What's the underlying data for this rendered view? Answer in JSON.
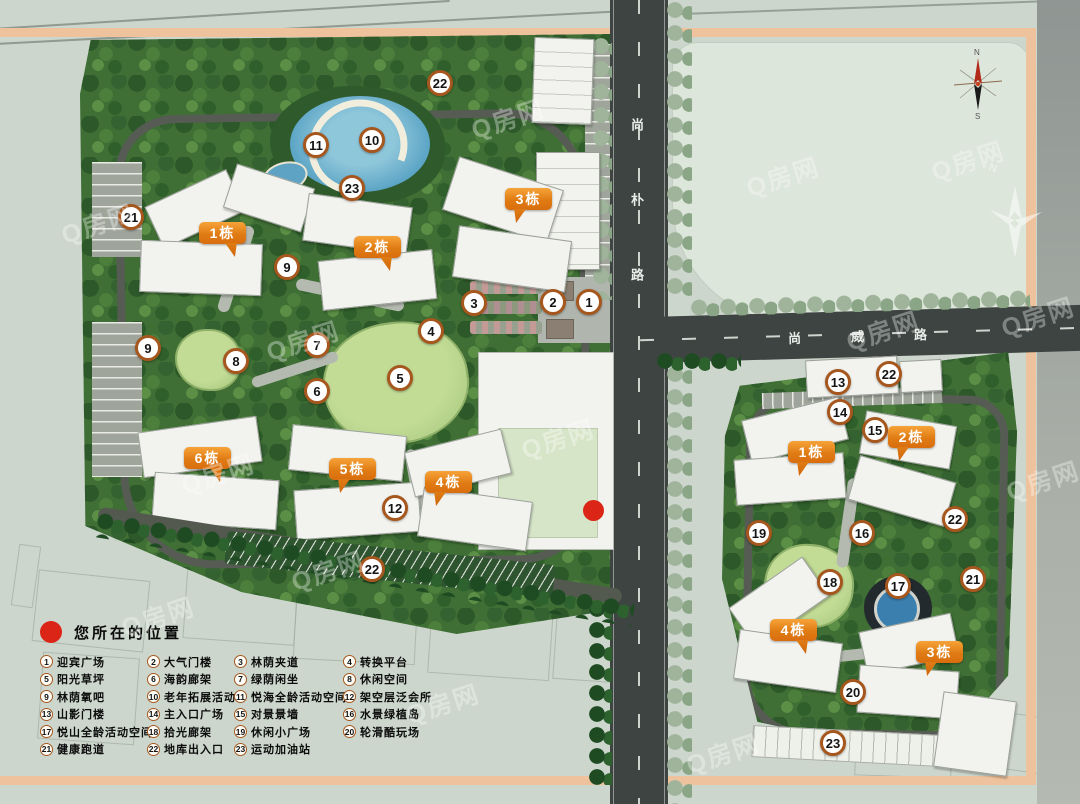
{
  "map": {
    "roads": {
      "vertical_road": "尚朴路",
      "horizontal_road": "尚威路"
    },
    "compass": {
      "north_label": "N",
      "south_label": "S"
    },
    "watermark_text": "Q房网"
  },
  "legend": {
    "title": "您所在的位置",
    "items": [
      {
        "num": "1",
        "label": "迎宾广场"
      },
      {
        "num": "2",
        "label": "大气门楼"
      },
      {
        "num": "3",
        "label": "林荫夹道"
      },
      {
        "num": "4",
        "label": "转换平台"
      },
      {
        "num": "5",
        "label": "阳光草坪"
      },
      {
        "num": "6",
        "label": "海韵廊架"
      },
      {
        "num": "7",
        "label": "绿荫闲坐"
      },
      {
        "num": "8",
        "label": "休闲空间"
      },
      {
        "num": "9",
        "label": "林荫氧吧"
      },
      {
        "num": "10",
        "label": "老年拓展活动"
      },
      {
        "num": "11",
        "label": "悦海全龄活动空间"
      },
      {
        "num": "12",
        "label": "架空层泛会所"
      },
      {
        "num": "13",
        "label": "山影门楼"
      },
      {
        "num": "14",
        "label": "主入口广场"
      },
      {
        "num": "15",
        "label": "对景景墙"
      },
      {
        "num": "16",
        "label": "水景绿植岛"
      },
      {
        "num": "17",
        "label": "悦山全龄活动空间"
      },
      {
        "num": "18",
        "label": "拾光廊架"
      },
      {
        "num": "19",
        "label": "休闲小广场"
      },
      {
        "num": "20",
        "label": "轮滑酷玩场"
      },
      {
        "num": "21",
        "label": "健康跑道"
      },
      {
        "num": "22",
        "label": "地库出入口"
      },
      {
        "num": "23",
        "label": "运动加油站"
      }
    ]
  },
  "building_labels": [
    {
      "plan": "left",
      "text": "1栋",
      "x": 199,
      "y": 222,
      "tail": "right"
    },
    {
      "plan": "left",
      "text": "2栋",
      "x": 354,
      "y": 236,
      "tail": "right"
    },
    {
      "plan": "left",
      "text": "3栋",
      "x": 505,
      "y": 188,
      "tail": "left"
    },
    {
      "plan": "left",
      "text": "6栋",
      "x": 184,
      "y": 447,
      "tail": "right"
    },
    {
      "plan": "left",
      "text": "5栋",
      "x": 329,
      "y": 458,
      "tail": "left"
    },
    {
      "plan": "left",
      "text": "4栋",
      "x": 425,
      "y": 471,
      "tail": "left"
    },
    {
      "plan": "right",
      "text": "1栋",
      "x": 788,
      "y": 441,
      "tail": "left"
    },
    {
      "plan": "right",
      "text": "2栋",
      "x": 888,
      "y": 426,
      "tail": "left"
    },
    {
      "plan": "right",
      "text": "4栋",
      "x": 770,
      "y": 619,
      "tail": "right"
    },
    {
      "plan": "right",
      "text": "3栋",
      "x": 916,
      "y": 641,
      "tail": "left"
    }
  ],
  "markers": [
    {
      "plan": "left",
      "n": "22",
      "x": 440,
      "y": 83
    },
    {
      "plan": "left",
      "n": "11",
      "x": 316,
      "y": 145
    },
    {
      "plan": "left",
      "n": "10",
      "x": 372,
      "y": 140
    },
    {
      "plan": "left",
      "n": "23",
      "x": 352,
      "y": 188
    },
    {
      "plan": "left",
      "n": "21",
      "x": 131,
      "y": 217
    },
    {
      "plan": "left",
      "n": "9",
      "x": 287,
      "y": 267
    },
    {
      "plan": "left",
      "n": "3",
      "x": 474,
      "y": 303
    },
    {
      "plan": "left",
      "n": "2",
      "x": 553,
      "y": 302
    },
    {
      "plan": "left",
      "n": "1",
      "x": 589,
      "y": 302
    },
    {
      "plan": "left",
      "n": "9",
      "x": 148,
      "y": 348
    },
    {
      "plan": "left",
      "n": "8",
      "x": 236,
      "y": 361
    },
    {
      "plan": "left",
      "n": "7",
      "x": 317,
      "y": 345
    },
    {
      "plan": "left",
      "n": "4",
      "x": 431,
      "y": 331
    },
    {
      "plan": "left",
      "n": "6",
      "x": 317,
      "y": 391
    },
    {
      "plan": "left",
      "n": "5",
      "x": 400,
      "y": 378
    },
    {
      "plan": "left",
      "n": "12",
      "x": 395,
      "y": 508
    },
    {
      "plan": "left",
      "n": "22",
      "x": 372,
      "y": 569
    },
    {
      "plan": "right",
      "n": "13",
      "x": 838,
      "y": 382
    },
    {
      "plan": "right",
      "n": "22",
      "x": 889,
      "y": 374
    },
    {
      "plan": "right",
      "n": "14",
      "x": 840,
      "y": 412
    },
    {
      "plan": "right",
      "n": "15",
      "x": 875,
      "y": 430
    },
    {
      "plan": "right",
      "n": "22",
      "x": 955,
      "y": 519
    },
    {
      "plan": "right",
      "n": "19",
      "x": 759,
      "y": 533
    },
    {
      "plan": "right",
      "n": "16",
      "x": 862,
      "y": 533
    },
    {
      "plan": "right",
      "n": "18",
      "x": 830,
      "y": 582
    },
    {
      "plan": "right",
      "n": "17",
      "x": 898,
      "y": 586
    },
    {
      "plan": "right",
      "n": "21",
      "x": 973,
      "y": 579
    },
    {
      "plan": "right",
      "n": "20",
      "x": 853,
      "y": 692
    },
    {
      "plan": "right",
      "n": "23",
      "x": 833,
      "y": 743
    }
  ],
  "location_dot": {
    "x": 594,
    "y": 511
  }
}
